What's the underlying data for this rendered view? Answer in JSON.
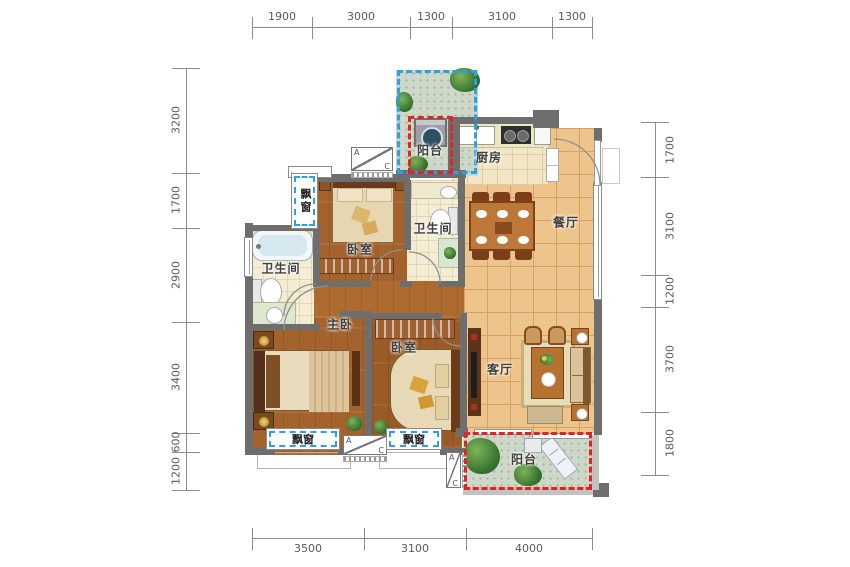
{
  "title": "三室两厅户型平面图",
  "colors": {
    "wall": "#6e6e6e",
    "wood_floor": "#a4622c",
    "tile_floor": "#eec48d",
    "bath_floor": "#f4ecd4",
    "garden_floor": "#ced8c9",
    "blue_dash": "#2aa0e6",
    "red_dash": "#e32222",
    "dim_text": "#5a5a5a"
  },
  "labels": {
    "balcony": "阳台",
    "kitchen": "厨房",
    "dining": "餐厅",
    "bath": "卫生间",
    "bedroom": "卧室",
    "master": "主卧",
    "living": "客厅",
    "bay_window": "飘窗"
  },
  "ac": {
    "a": "A",
    "c": "C"
  },
  "dims": {
    "top": [
      "1900",
      "3000",
      "1300",
      "3100",
      "1300"
    ],
    "left": [
      "3200",
      "1700",
      "2900",
      "3400",
      "600",
      "1200"
    ],
    "right": [
      "1700",
      "3100",
      "1200",
      "3700",
      "1800"
    ],
    "bottom": [
      "3500",
      "3100",
      "4000"
    ]
  }
}
